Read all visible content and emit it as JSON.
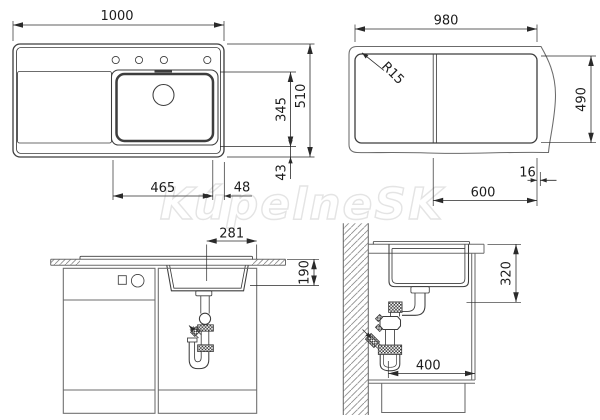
{
  "watermark_text": "KúpelneSK",
  "plan_view": {
    "overall_width": "1000",
    "overall_depth": "510",
    "bowl_length": "345",
    "bowl_to_front": "43",
    "bowl_width": "465",
    "bowl_to_edge": "48"
  },
  "cutout_view": {
    "cutout_width": "980",
    "cutout_depth": "490",
    "corner_radius": "R15",
    "bowl_section_width": "600",
    "edge_gap": "16"
  },
  "front_view": {
    "drain_offset": "281",
    "bowl_depth": "190"
  },
  "side_view": {
    "mounting_depth": "320",
    "wall_clearance": "400"
  }
}
